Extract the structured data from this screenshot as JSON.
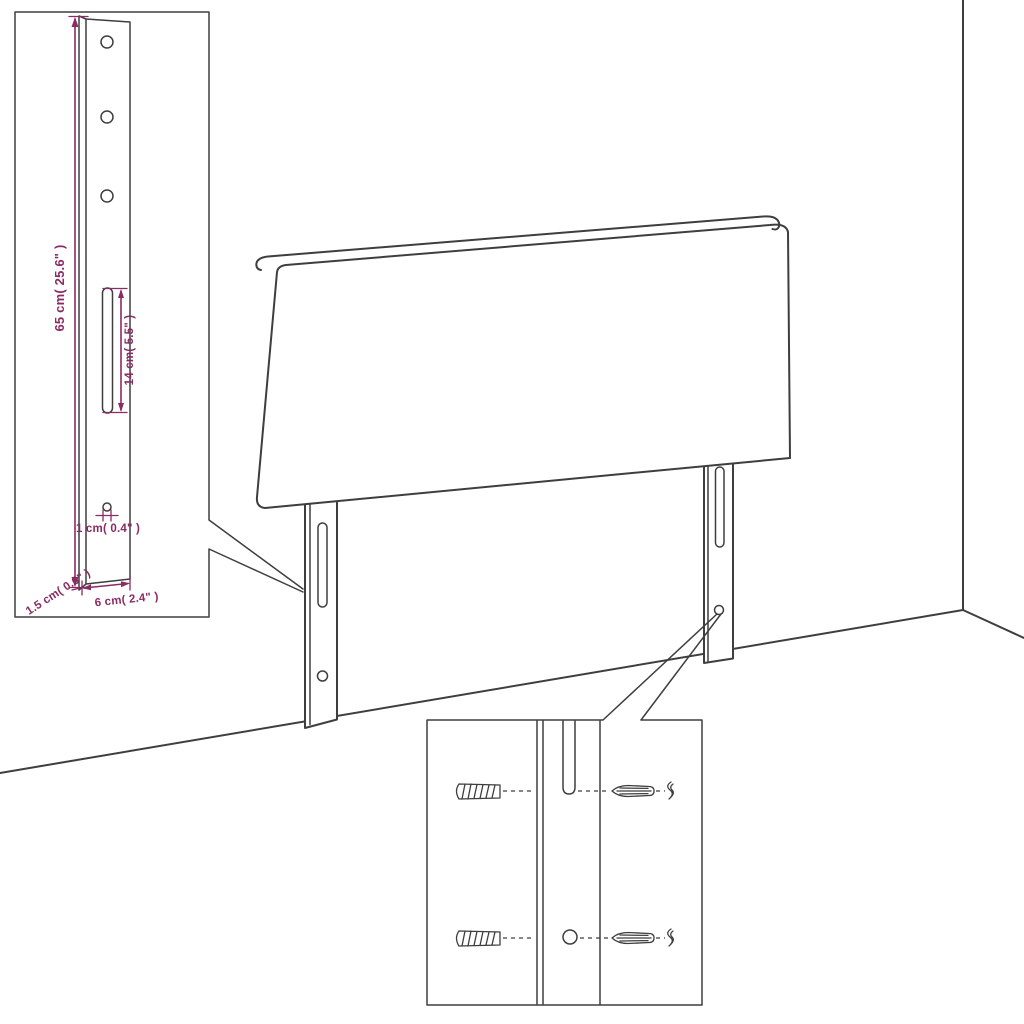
{
  "diagram": {
    "colors": {
      "line": "#3e3e3e",
      "dimension": "#8a2b63",
      "background": "#ffffff"
    },
    "bracket_detail": {
      "height_label": "65 cm( 25.6\" )",
      "slot_label": "14 cm( 5.5\" )",
      "hole_label": "1 cm( 0.4\" )",
      "depth_label": "1.5 cm( 0.6\" )",
      "width_label": "6 cm( 2.4\" )"
    }
  }
}
